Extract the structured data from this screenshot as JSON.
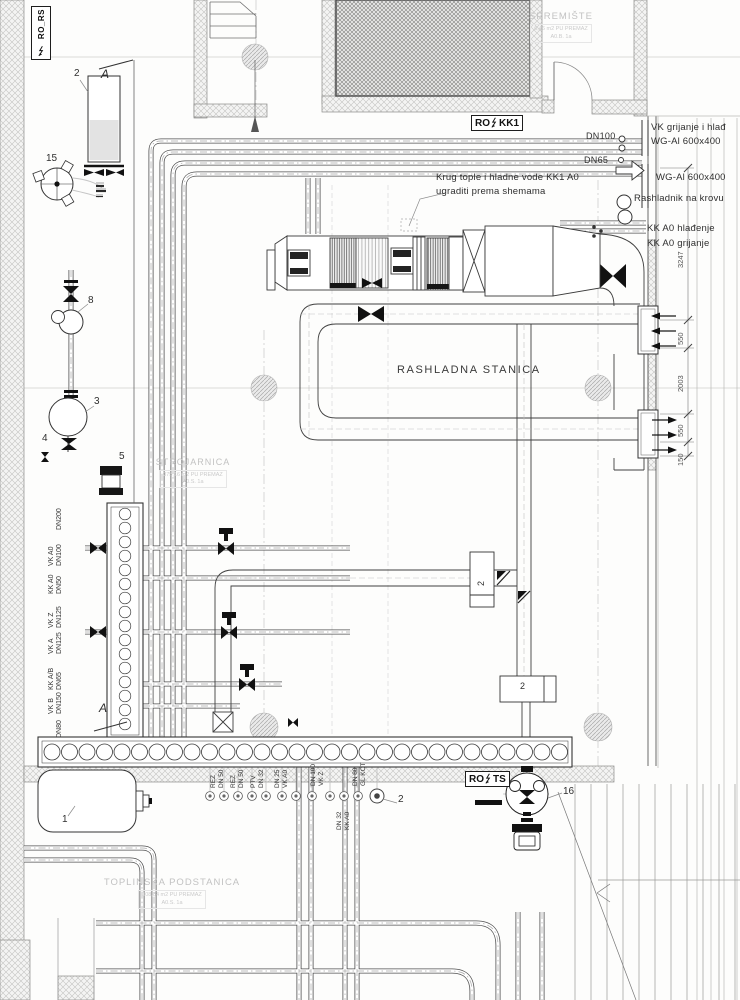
{
  "drawing": {
    "panels": {
      "ro_rs": {
        "text": "RO_RS"
      },
      "ro_kk1": {
        "left": "RO",
        "right": "KK1"
      },
      "ro_ts": {
        "left": "RO",
        "right": "TS"
      }
    },
    "rooms": {
      "spremiste": {
        "name": "SPREMIŠTE",
        "area": "6,46 m2 PU PREMAZ",
        "code": "A0.B. 1a"
      },
      "strojarnica": {
        "name": "STROJARNICA",
        "area": "375,16 m2 PU PREMAZ",
        "code": "A0.S. 1a"
      },
      "rashladna": {
        "name": "RASHLADNA STANICA"
      },
      "toplinska": {
        "name": "TOPLINSKA PODSTANICA",
        "area": "108,84 m2 PU PREMAZ",
        "code": "A0.S. 1a"
      }
    },
    "notes": {
      "krug_line1": "Krug tople i hladne vode KK1 A0",
      "krug_line2": "ugraditi prema shemama",
      "rashladnik": "Rashladnik na krovu",
      "vk_grijanje": "VK grijanje i hlađ",
      "wg_duct_upper": "WG-Al 600x400",
      "wg_duct_lower": "WG-Al 600x400",
      "kk_hladjenje": "KK A0 hlađenje",
      "kk_grijanje": "KK A0 grijanje"
    },
    "pipe_tags": {
      "dn100": "DN100",
      "dn65": "DN65"
    },
    "dimensions": {
      "d1": "3247",
      "d2": "550",
      "d3": "2003",
      "d4": "550",
      "d5": "150"
    },
    "items": {
      "n1": "1",
      "n2_vessel": "2",
      "n2_box_mid": "2",
      "n2_box_low": "2",
      "n2_flange": "2",
      "n3": "3",
      "n4": "4",
      "n5": "5",
      "n8": "8",
      "n15": "15",
      "n16": "16"
    },
    "section_marks": {
      "top": "A",
      "bottom": "A"
    },
    "pipe_labels_left": [
      {
        "l1": "",
        "l2": "DN200"
      },
      {
        "l1": "VK A0",
        "l2": "DN100"
      },
      {
        "l1": "KK A0",
        "l2": "DN50"
      },
      {
        "l1": "VK Z",
        "l2": "DN125"
      },
      {
        "l1": "VK A",
        "l2": "DN125"
      },
      {
        "l1": "KK A/B",
        "l2": "DN65"
      },
      {
        "l1": "VK B",
        "l2": "DN150"
      },
      {
        "l1": "",
        "l2": "DN80"
      }
    ],
    "pipe_labels_bottom": [
      {
        "l1": "REZ",
        "l2": "DN 50"
      },
      {
        "l1": "REZ",
        "l2": "DN 50"
      },
      {
        "l1": "PTV",
        "l2": "DN 32"
      },
      {
        "l1": "DN 25",
        "l2": "VK A0"
      },
      {
        "l1": "DN 100",
        "l2": "VK Z"
      },
      {
        "l1": "DN 80",
        "l2": "GL KOT"
      }
    ],
    "pipe_label_dn32": {
      "l1": "DN 32",
      "l2": "KK A0"
    }
  }
}
